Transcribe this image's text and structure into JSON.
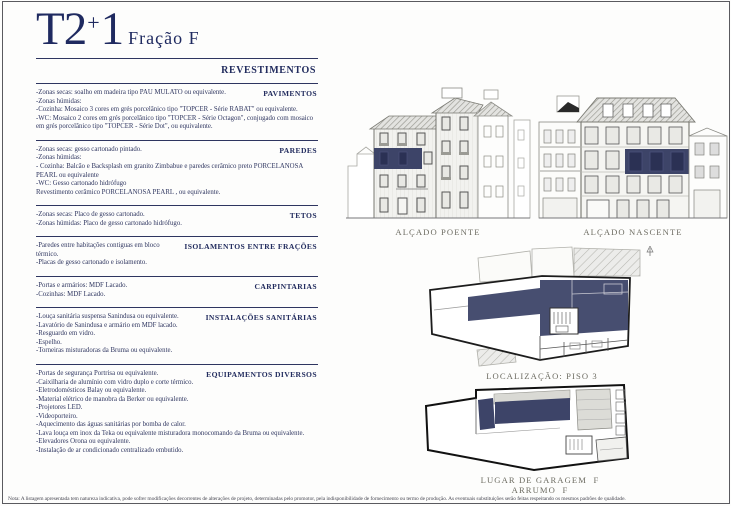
{
  "title": {
    "main": "T2",
    "plus": "+",
    "one": "1",
    "fraction": "Fração F"
  },
  "revestimentos_header": "REVESTIMENTOS",
  "sections": [
    {
      "header": "PAVIMENTOS",
      "lines": [
        "-Zonas secas: soalho em madeira tipo PAU MULATO ou equivalente.",
        "-Zonas húmidas:",
        "-Cozinha: Mosaico 3 cores em grés porcelânico tipo \"TOPCER - Série RABAT\" ou equivalente.",
        "-WC: Mosaico 2 cores em grés porcelânico tipo \"TOPCER - Série Octagon\", conjugado com mosaico em grés porcelânico tipo \"TOPCER - Série Dot\", ou equivalente."
      ]
    },
    {
      "header": "PAREDES",
      "lines": [
        "-Zonas secas: gesso cartonado pintado.",
        "-Zonas húmidas:",
        "- Cozinha: Balcão e Backsplash em granito Zimbabue e paredes cerâmico preto PORCELANOSA PEARL ou equivalente",
        "-WC: Gesso cartonado hidrófugo",
        " Revestimento cerâmico PORCELANOSA PEARL , ou equivalente."
      ]
    },
    {
      "header": "TETOS",
      "lines": [
        "-Zonas secas: Placo de gesso cartonado.",
        "-Zonas húmidas: Placo de gesso cartonado hidrófugo."
      ]
    },
    {
      "header": "ISOLAMENTOS ENTRE FRAÇÕES",
      "lines": [
        "-Paredes entre habitações contiguas em bloco térmico.",
        "-Placas de gesso cartonado e isolamento."
      ]
    },
    {
      "header": "CARPINTARIAS",
      "lines": [
        "-Portas e armários: MDF Lacado.",
        "-Cozinhas: MDF Lacado."
      ]
    },
    {
      "header": "INSTALAÇÕES SANITÁRIAS",
      "lines": [
        "-Louça sanitária suspensa Sanindusa ou equivalente.",
        "-Lavatório de Sanindusa e armário em MDF lacado.",
        "-Resguardo em vidro.",
        "-Espelho.",
        "-Torneiras misturadoras da Bruma ou equivalente."
      ]
    },
    {
      "header": "EQUIPAMENTOS DIVERSOS",
      "lines": [
        "-Portas de segurança Portrisa ou equivalente.",
        "-Caixilharia de alumínio com vidro duplo e corte térmico.",
        "-Eletrodomésticos Balay ou equivalente.",
        "-Material elétrico de manobra da Berker ou equivalente.",
        "-Projetores LED.",
        "-Videoporteiro.",
        "-Aquecimento das águas sanitárias por bomba de calor.",
        "-Lava louça em inox da Teka ou equivalente misturadora monocomando da Bruma ou equivalente.",
        "-Elevadores Orona ou equivalente.",
        "-Instalação de ar condicionado centralizado embutido."
      ]
    }
  ],
  "drawings": {
    "poente": {
      "caption": "ALÇADO POENTE"
    },
    "nascente": {
      "caption": "ALÇADO NASCENTE"
    },
    "piso3": {
      "caption": "LOCALIZAÇÃO: PISO 3"
    },
    "garagem": {
      "caption_line1": "LUGAR DE GARAGEM  F",
      "caption_line2": "ARRUMO  F"
    }
  },
  "footer_note": "Nota: A listagem apresentada tem natureza indicativa, pode sofrer modificações decorrentes de alterações de projeto, determinadas pelo promotor, pela indisponibilidade de fornecimento ou termo de produção. As eventuais substituições serão feitas respeitando os mesmos padrões de qualidade.",
  "colors": {
    "title_navy": "#1f2a60",
    "highlight_navy": "#3d4468",
    "caption_gray": "#6e6d63",
    "rule_navy": "#2e3560"
  }
}
